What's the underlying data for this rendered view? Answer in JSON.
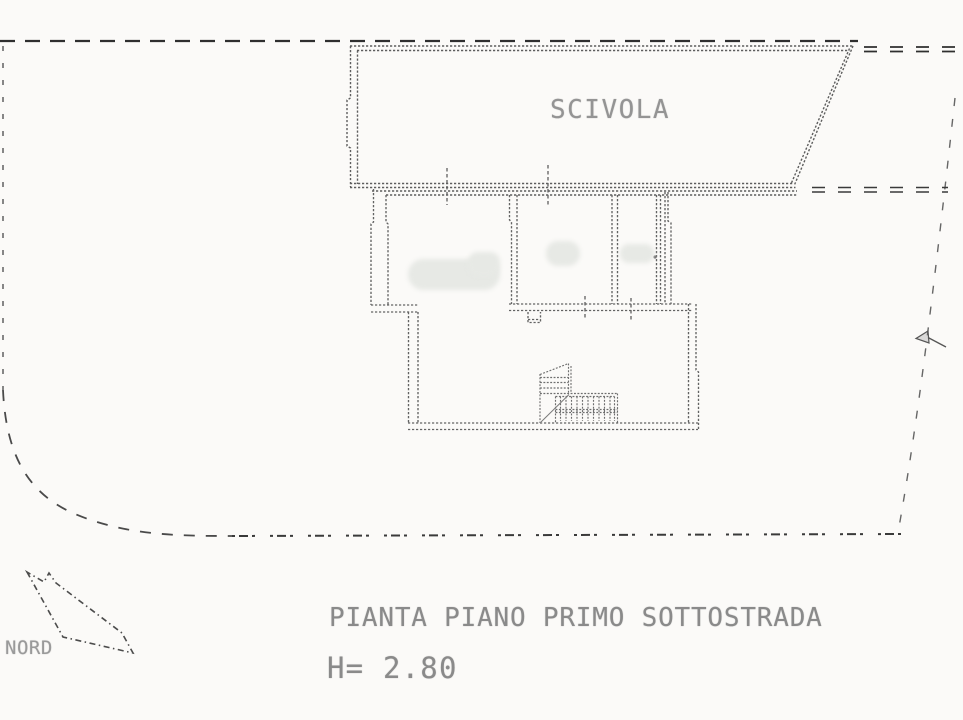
{
  "drawing": {
    "room_label": "SCIVOLA",
    "title": "PIANTA PIANO PRIMO SOTTOSTRADA",
    "height_note": "H= 2.80",
    "north_label": "NORD"
  },
  "icons": {
    "north_arrow": "north-arrow-icon",
    "survey_marker": "survey-marker-icon"
  },
  "colors": {
    "paper": "#fbfaf8",
    "wall_ink": "#5e5e5e",
    "boundary_ink": "#333333",
    "text_ink": "#8a8a8a",
    "smudge": "#e7e9e5"
  }
}
